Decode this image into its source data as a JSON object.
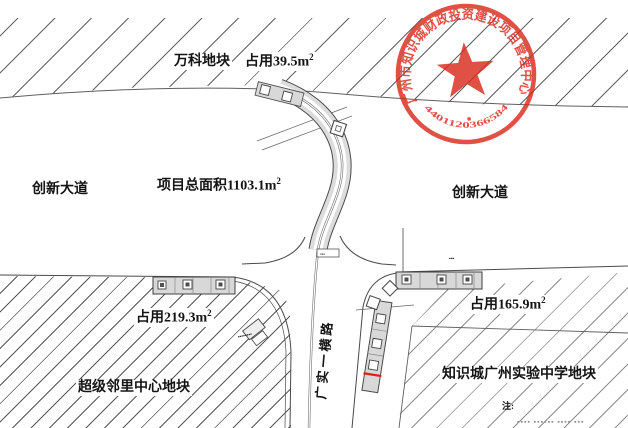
{
  "parcels": {
    "north": {
      "name": "万科地块",
      "occupied": "占用39.5m",
      "occupied_sup": "2"
    },
    "southwest": {
      "name": "超级邻里中心地块",
      "occupied": "占用219.3m",
      "occupied_sup": "2"
    },
    "southeast": {
      "name": "知识城广州实验中学地块",
      "occupied": "占用165.9m",
      "occupied_sup": "2"
    }
  },
  "roads": {
    "west_avenue": "创新大道",
    "east_avenue": "创新大道",
    "south_road": "广实一横路"
  },
  "project": {
    "total_area": "项目总面积1103.1m",
    "total_area_sup": "2"
  },
  "seal": {
    "ring_text": "广州市知识城财政投资建设项目管理中心",
    "serial_number": "4401120366584",
    "color": "#d92a1d",
    "center_icon": "red-star"
  },
  "annotations": {
    "note_label": "注:",
    "note_cutoff_text": "▪▪▪▪ ▪▪▪▪▪▪ ▪▪▪▪ ▪▪▪",
    "top_edge_clipped_text": "▪▪",
    "station_tiny_label": "▪▪▪",
    "sw_tiny_label": "▪▪▪▪▪▪▪▪",
    "center_road_tiny_label": "▪▪▪"
  },
  "colors": {
    "seal_red": "#d92a1d",
    "drawing_line": "#4a4a4a",
    "road_fill": "#d8d8d8",
    "hatch_line": "#5a5a5a"
  }
}
